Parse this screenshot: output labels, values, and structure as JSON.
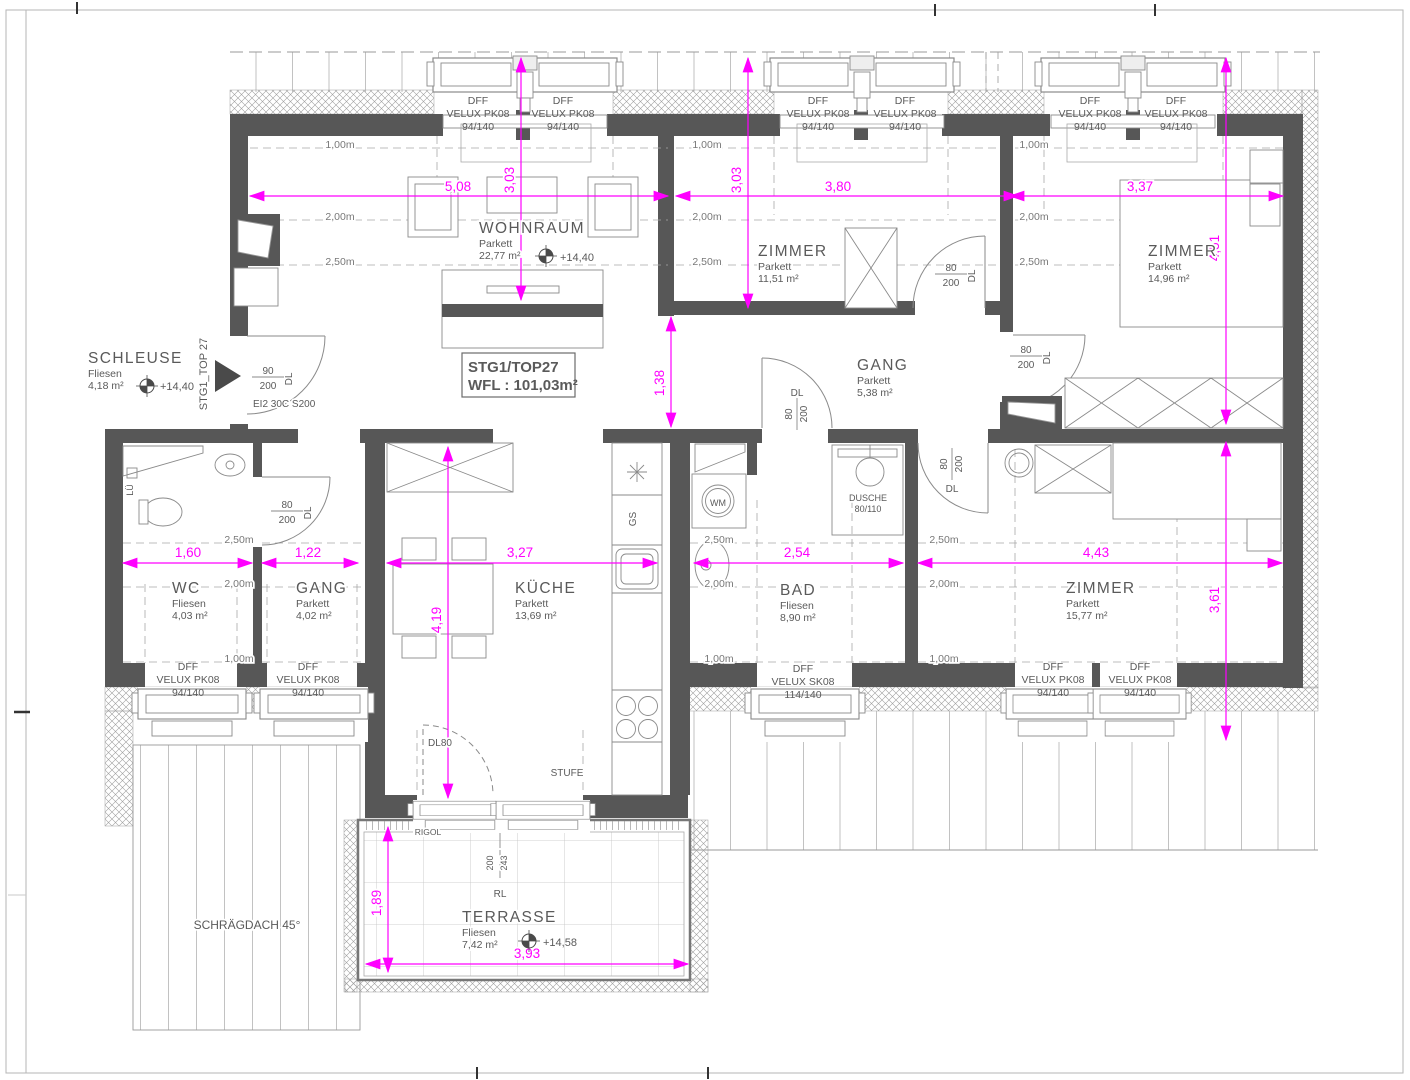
{
  "title_box": {
    "line1": "STG1/TOP27",
    "line2": "WFL : 101,03m²"
  },
  "colors": {
    "wall": "#575757",
    "dimension": "#ff00ff",
    "line": "#8a8a8a",
    "text": "#5a5a5a"
  },
  "rooms": [
    {
      "name": "WOHNRAUM",
      "floor": "Parkett",
      "area": "22,77 m²",
      "x": 479,
      "y": 233,
      "level": {
        "text": "+14,40",
        "x": 560,
        "y": 261,
        "sx": 546,
        "sy": 256
      }
    },
    {
      "name": "ZIMMER",
      "floor": "Parkett",
      "area": "11,51 m²",
      "x": 758,
      "y": 256
    },
    {
      "name": "ZIMMER",
      "floor": "Parkett",
      "area": "14,96 m²",
      "x": 1148,
      "y": 256
    },
    {
      "name": "GANG",
      "floor": "Parkett",
      "area": "5,38 m²",
      "x": 857,
      "y": 370
    },
    {
      "name": "SCHLEUSE",
      "floor": "Fliesen",
      "area": "4,18 m²",
      "x": 88,
      "y": 363,
      "level": {
        "text": "+14,40",
        "x": 160,
        "y": 390,
        "sx": 147,
        "sy": 386
      }
    },
    {
      "name": "WC",
      "floor": "Fliesen",
      "area": "4,03 m²",
      "x": 172,
      "y": 593
    },
    {
      "name": "GANG",
      "floor": "Parkett",
      "area": "4,02 m²",
      "x": 296,
      "y": 593
    },
    {
      "name": "KÜCHE",
      "floor": "Parkett",
      "area": "13,69 m²",
      "x": 515,
      "y": 593
    },
    {
      "name": "BAD",
      "floor": "Fliesen",
      "area": "8,90 m²",
      "x": 780,
      "y": 595
    },
    {
      "name": "ZIMMER",
      "floor": "Parkett",
      "area": "15,77 m²",
      "x": 1066,
      "y": 593
    },
    {
      "name": "TERRASSE",
      "floor": "Fliesen",
      "area": "7,42 m²",
      "x": 462,
      "y": 922,
      "level": {
        "text": "+14,58",
        "x": 543,
        "y": 946,
        "sx": 529,
        "sy": 941
      }
    }
  ],
  "window_labels": [
    {
      "x": 478,
      "y": 104,
      "lines": [
        "DFF",
        "VELUX PK08",
        "94/140"
      ]
    },
    {
      "x": 563,
      "y": 104,
      "lines": [
        "DFF",
        "VELUX PK08",
        "94/140"
      ]
    },
    {
      "x": 818,
      "y": 104,
      "lines": [
        "DFF",
        "VELUX PK08",
        "94/140"
      ]
    },
    {
      "x": 905,
      "y": 104,
      "lines": [
        "DFF",
        "VELUX PK08",
        "94/140"
      ]
    },
    {
      "x": 1090,
      "y": 104,
      "lines": [
        "DFF",
        "VELUX PK08",
        "94/140"
      ]
    },
    {
      "x": 1176,
      "y": 104,
      "lines": [
        "DFF",
        "VELUX PK08",
        "94/140"
      ]
    },
    {
      "x": 188,
      "y": 670,
      "lines": [
        "DFF",
        "VELUX PK08",
        "94/140"
      ]
    },
    {
      "x": 308,
      "y": 670,
      "lines": [
        "DFF",
        "VELUX PK08",
        "94/140"
      ]
    },
    {
      "x": 803,
      "y": 672,
      "lines": [
        "DFF",
        "VELUX SK08",
        "114/140"
      ]
    },
    {
      "x": 1053,
      "y": 670,
      "lines": [
        "DFF",
        "VELUX PK08",
        "94/140"
      ]
    },
    {
      "x": 1140,
      "y": 670,
      "lines": [
        "DFF",
        "VELUX PK08",
        "94/140"
      ]
    }
  ],
  "dims": {
    "h": [
      {
        "v": "5,08",
        "x1": 250,
        "x2": 668,
        "y": 196,
        "lx": 458,
        "ly": 191
      },
      {
        "v": "3,80",
        "x1": 676,
        "x2": 1018,
        "y": 196,
        "lx": 838,
        "ly": 191
      },
      {
        "v": "3,37",
        "x1": 1010,
        "x2": 1283,
        "y": 196,
        "lx": 1140,
        "ly": 191
      },
      {
        "v": "1,60",
        "x1": 123,
        "x2": 252,
        "y": 563,
        "lx": 188,
        "ly": 557
      },
      {
        "v": "1,22",
        "x1": 262,
        "x2": 358,
        "y": 563,
        "lx": 308,
        "ly": 557
      },
      {
        "v": "3,27",
        "x1": 387,
        "x2": 657,
        "y": 563,
        "lx": 520,
        "ly": 557
      },
      {
        "v": "2,54",
        "x1": 694,
        "x2": 903,
        "y": 563,
        "lx": 797,
        "ly": 557
      },
      {
        "v": "4,43",
        "x1": 918,
        "x2": 1282,
        "y": 563,
        "lx": 1096,
        "ly": 557
      },
      {
        "v": "3,93",
        "x1": 366,
        "x2": 688,
        "y": 964,
        "lx": 527,
        "ly": 958
      }
    ],
    "v": [
      {
        "v": "3,03",
        "x": 521,
        "y1": 58,
        "y2": 300,
        "lx": 514,
        "ly": 180
      },
      {
        "v": "3,03",
        "x": 748,
        "y1": 58,
        "y2": 308,
        "lx": 741,
        "ly": 180
      },
      {
        "v": "4,51",
        "x": 1226,
        "y1": 58,
        "y2": 424,
        "lx": 1219,
        "ly": 248
      },
      {
        "v": "1,38",
        "x": 671,
        "y1": 317,
        "y2": 427,
        "lx": 664,
        "ly": 383
      },
      {
        "v": "4,19",
        "x": 448,
        "y1": 447,
        "y2": 798,
        "lx": 441,
        "ly": 620
      },
      {
        "v": "3,61",
        "x": 1226,
        "y1": 442,
        "y2": 740,
        "lx": 1219,
        "ly": 600
      },
      {
        "v": "1,89",
        "x": 388,
        "y1": 827,
        "y2": 972,
        "lx": 381,
        "ly": 903
      }
    ]
  },
  "contours": [
    {
      "t": "1,00m",
      "x": 340,
      "y": 148
    },
    {
      "t": "1,00m",
      "x": 707,
      "y": 148
    },
    {
      "t": "1,00m",
      "x": 1034,
      "y": 148
    },
    {
      "t": "2,00m",
      "x": 340,
      "y": 220
    },
    {
      "t": "2,00m",
      "x": 707,
      "y": 220
    },
    {
      "t": "2,00m",
      "x": 1034,
      "y": 220
    },
    {
      "t": "2,50m",
      "x": 340,
      "y": 265
    },
    {
      "t": "2,50m",
      "x": 707,
      "y": 265
    },
    {
      "t": "2,50m",
      "x": 1034,
      "y": 265
    },
    {
      "t": "2,50m",
      "x": 239,
      "y": 543
    },
    {
      "t": "2,50m",
      "x": 719,
      "y": 543
    },
    {
      "t": "2,50m",
      "x": 944,
      "y": 543
    },
    {
      "t": "2,00m",
      "x": 239,
      "y": 587
    },
    {
      "t": "2,00m",
      "x": 719,
      "y": 587
    },
    {
      "t": "2,00m",
      "x": 944,
      "y": 587
    },
    {
      "t": "1,00m",
      "x": 239,
      "y": 662
    },
    {
      "t": "1,00m",
      "x": 719,
      "y": 662
    },
    {
      "t": "1,00m",
      "x": 944,
      "y": 662
    }
  ],
  "door_tags": [
    {
      "num": "90",
      "den": "200",
      "dl": "DL",
      "x": 268,
      "y": 377,
      "rot": false
    },
    {
      "num": "80",
      "den": "200",
      "dl": "DL",
      "x": 287,
      "y": 511,
      "rot": false
    },
    {
      "num": "80",
      "den": "200",
      "dl": "DL",
      "x": 951,
      "y": 274,
      "rot": false
    },
    {
      "num": "80",
      "den": "200",
      "dl": "DL",
      "x": 1026,
      "y": 356,
      "rot": false
    },
    {
      "num": "80",
      "den": "200",
      "dl": "DL",
      "x": 797,
      "y": 414,
      "rot": true,
      "dlx": 797,
      "dly": 396
    },
    {
      "num": "80",
      "den": "200",
      "dl": "DL",
      "x": 952,
      "y": 464,
      "rot": true,
      "dlx": 952,
      "dly": 492
    }
  ],
  "misc": [
    {
      "t": "STG1_TOP 27",
      "x": 207,
      "y": 374,
      "s": 11,
      "r": -90
    },
    {
      "t": "EI2 30C S200",
      "x": 253,
      "y": 407,
      "s": 10,
      "a": "start"
    },
    {
      "t": "DL80",
      "x": 440,
      "y": 746,
      "s": 10
    },
    {
      "t": "DUSCHE",
      "x": 868,
      "y": 501,
      "s": 9
    },
    {
      "t": "80/110",
      "x": 868,
      "y": 512,
      "s": 9
    },
    {
      "t": "WM",
      "x": 718,
      "y": 506,
      "s": 9
    },
    {
      "t": "GS",
      "x": 636,
      "y": 519,
      "s": 10,
      "r": -90
    },
    {
      "t": "LÜ",
      "x": 133,
      "y": 490,
      "s": 9,
      "r": -90
    },
    {
      "t": "STUFE",
      "x": 567,
      "y": 776,
      "s": 10
    },
    {
      "t": "RIGOL",
      "x": 428,
      "y": 835,
      "s": 8.5
    },
    {
      "t": "RL",
      "x": 500,
      "y": 897,
      "s": 10
    },
    {
      "t": "200",
      "x": 493,
      "y": 863,
      "s": 9,
      "r": -90
    },
    {
      "t": "243",
      "x": 507,
      "y": 863,
      "s": 9,
      "r": -90
    },
    {
      "t": "SCHRÄGDACH 45°",
      "x": 247,
      "y": 929,
      "s": 12
    }
  ]
}
